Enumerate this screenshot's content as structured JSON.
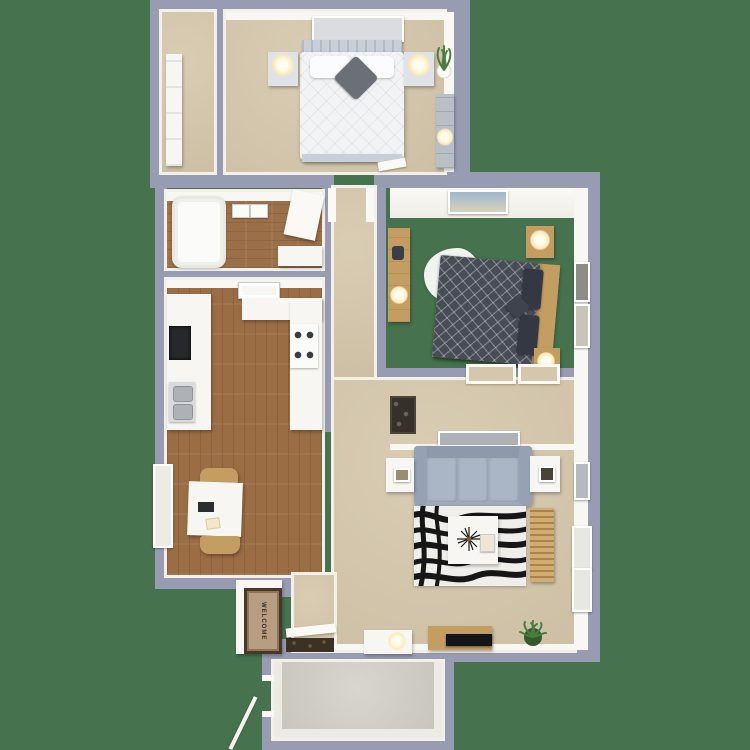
{
  "scene": {
    "description": "Top-down 3D rendered floor plan of a two-bedroom apartment with kitchen, bathroom, living room, dining area, entry and patio",
    "background_color": "#47724E"
  },
  "palette": {
    "wall": "#989CB2",
    "wall_trim": "#F2F0E9",
    "carpet": "#D5C7AB",
    "wood_floor": "#9A6D45",
    "patio_concrete": "#D3D0C7",
    "sofa_gray_blue": "#9FABBB",
    "bed1_white": "#F1F3F5",
    "bed2_charcoal": "#474C57",
    "furniture_wood": "#C49D63",
    "rug_black": "#161616",
    "plant_green": "#4C7C3F"
  },
  "entry": {
    "mat_label": "WELCOME"
  },
  "furniture_inventory": {
    "bedroom_1": [
      "wall-art",
      "headboard",
      "double-bed-white",
      "pillows",
      "accent-pillow",
      "nightstand-left",
      "nightstand-right",
      "lamps",
      "potted-plant",
      "dresser"
    ],
    "closet": [
      "wardrobe"
    ],
    "bathroom": [
      "bathtub",
      "wall-cabinets",
      "open-door",
      "vanity"
    ],
    "kitchen": [
      "ceiling-light",
      "upper-counter",
      "left-counter",
      "right-counter",
      "stove",
      "double-sink",
      "dark-cabinet"
    ],
    "dining": [
      "window",
      "square-table",
      "laptop",
      "papers",
      "chair-top",
      "chair-bottom"
    ],
    "bedroom_2": [
      "wall-art",
      "desk",
      "sheepskin-rug",
      "double-bed-charcoal",
      "dark-pillows",
      "wood-headboard",
      "nightstand-top",
      "nightstand-bottom",
      "wall-frames"
    ],
    "hall": [
      "linen-closet-shelves",
      "door-frames"
    ],
    "living_room": [
      "wall-art",
      "sofa",
      "end-table-left",
      "end-table-right",
      "zebra-rug",
      "coffee-table",
      "decor-starburst",
      "slatted-bench",
      "wall-picture",
      "windows",
      "tv-console",
      "tv",
      "media-cabinet",
      "potted-plant"
    ],
    "entry": [
      "welcome-mat",
      "interior-doormat",
      "front-door-leaf"
    ],
    "patio": [
      "gate-opening",
      "stair-rail"
    ]
  }
}
